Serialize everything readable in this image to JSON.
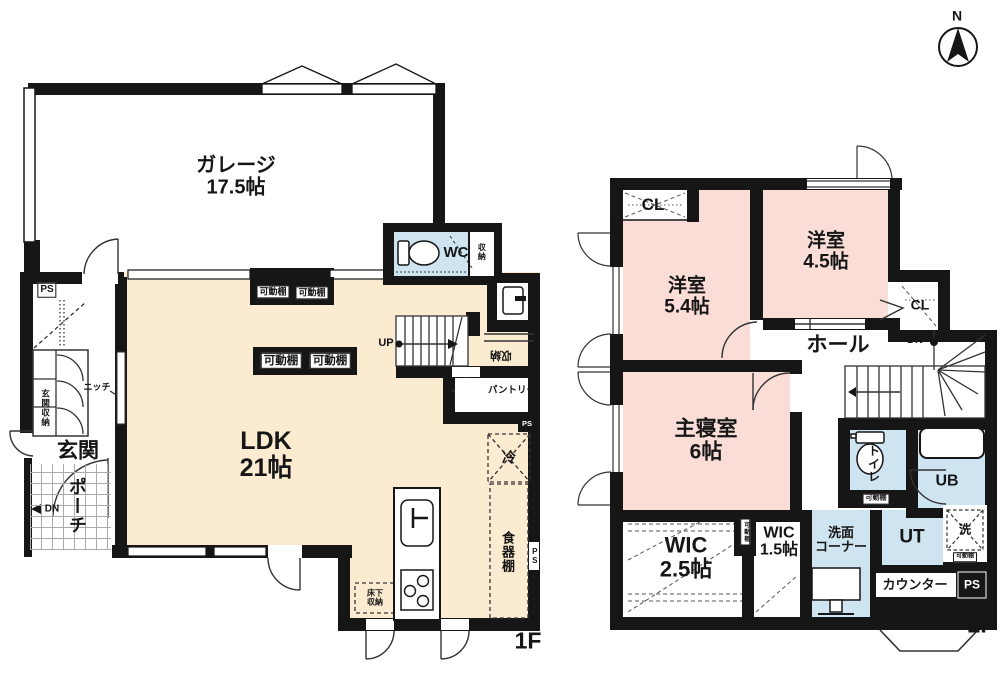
{
  "compass": {
    "north": "N"
  },
  "colors": {
    "wall": "#161616",
    "floor_cream": "#FBEBD0",
    "floor_pink": "#F9DDD6",
    "floor_blue": "#CEE4F1"
  },
  "floor1": {
    "floor_label": "1F",
    "garage_name": "ガレージ",
    "garage_size": "17.5帖",
    "ldk_name": "LDK",
    "ldk_size": "21帖",
    "wc": "WC",
    "wc_storage": "収納",
    "ps_top": "PS",
    "entrance_storage": "玄関収納",
    "niche": "ニッチ",
    "entrance": "玄関",
    "porch": "ポーチ",
    "porch_dn": "DN",
    "shelf1": "可動棚",
    "shelf2": "可動棚",
    "shelf3": "可動棚",
    "shelf4": "可動棚",
    "up": "UP",
    "stairs_storage": "収納",
    "pantry": "パントリー",
    "ps_mid": "PS",
    "fridge": "冷",
    "cupboard": "食器棚",
    "ps_right": "PS",
    "floor_storage_l1": "床下",
    "floor_storage_l2": "収納"
  },
  "floor2": {
    "floor_label": "2F",
    "cl_left": "CL",
    "cl_right": "CL",
    "room1_name": "洋室",
    "room1_size": "5.4帖",
    "room2_name": "洋室",
    "room2_size": "4.5帖",
    "hall": "ホール",
    "dn": "DN",
    "master_name": "主寝室",
    "master_size": "6帖",
    "wic1_name": "WIC",
    "wic1_size": "2.5帖",
    "wic_shelf": "可動棚",
    "wic2_name": "WIC",
    "wic2_size": "1.5帖",
    "washroom_l1": "洗面",
    "washroom_l2": "コーナー",
    "toilet": "トイレ",
    "toilet_shelf": "可動棚",
    "ub": "UB",
    "ut": "UT",
    "laundry": "洗",
    "laundry_shelf": "可動棚",
    "counter": "カウンター",
    "ps": "PS"
  }
}
